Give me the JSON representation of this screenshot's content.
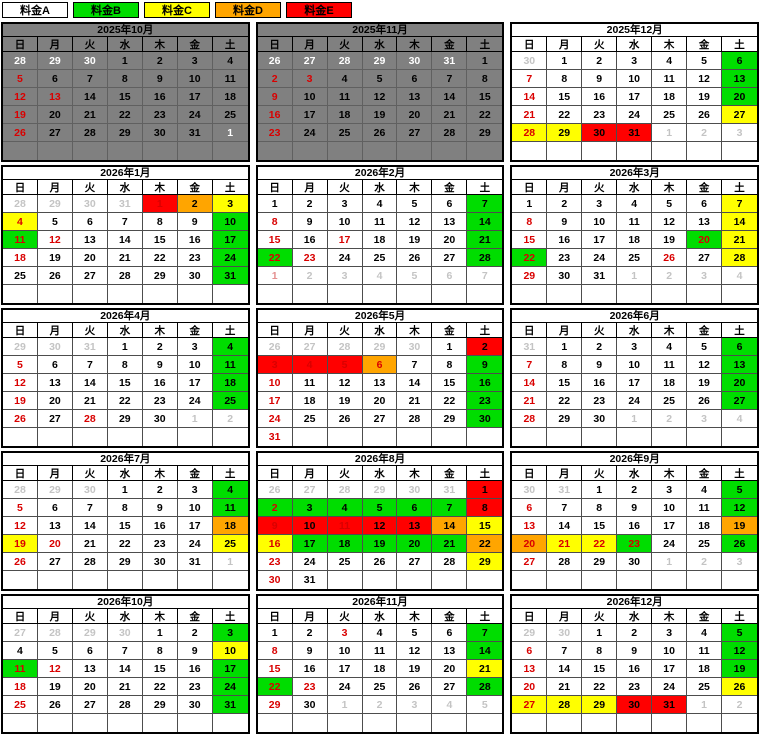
{
  "legend": [
    {
      "label": "料金A",
      "tier": "A"
    },
    {
      "label": "料金B",
      "tier": "B"
    },
    {
      "label": "料金C",
      "tier": "C"
    },
    {
      "label": "料金D",
      "tier": "D"
    },
    {
      "label": "料金E",
      "tier": "E"
    }
  ],
  "colors": {
    "A": "#ffffff",
    "B": "#00dd00",
    "C": "#ffff00",
    "D": "#ffa500",
    "E": "#ff0000",
    "disabled_bg": "#808080",
    "text_black": "#000000",
    "text_red": "#d90000",
    "text_white": "#ffffff",
    "text_dim": "#c4c4c4",
    "text_palered": "#e49090"
  },
  "weekday_headers": [
    "日",
    "月",
    "火",
    "水",
    "木",
    "金",
    "土"
  ],
  "months": [
    {
      "title": "2025年10月",
      "disabled": true,
      "weeks": [
        [
          "28|w",
          "29|w",
          "30|w",
          "1|k",
          "2|k",
          "3|k",
          "4|k"
        ],
        [
          "5|r",
          "6|k",
          "7|k",
          "8|k",
          "9|k",
          "10|k",
          "11|k"
        ],
        [
          "12|r",
          "13|r",
          "14|k",
          "15|k",
          "16|k",
          "17|k",
          "18|k"
        ],
        [
          "19|r",
          "20|k",
          "21|k",
          "22|k",
          "23|k",
          "24|k",
          "25|k"
        ],
        [
          "26|r",
          "27|k",
          "28|k",
          "29|k",
          "30|k",
          "31|k",
          "1|w"
        ],
        [
          "",
          "",
          "",
          "",
          "",
          "",
          ""
        ]
      ]
    },
    {
      "title": "2025年11月",
      "disabled": true,
      "weeks": [
        [
          "26|w",
          "27|w",
          "28|w",
          "29|w",
          "30|w",
          "31|w",
          "1|k"
        ],
        [
          "2|r",
          "3|r",
          "4|k",
          "5|k",
          "6|k",
          "7|k",
          "8|k"
        ],
        [
          "9|r",
          "10|k",
          "11|k",
          "12|k",
          "13|k",
          "14|k",
          "15|k"
        ],
        [
          "16|r",
          "17|k",
          "18|k",
          "19|k",
          "20|k",
          "21|k",
          "22|k"
        ],
        [
          "23|r",
          "24|k",
          "25|k",
          "26|k",
          "27|k",
          "28|k",
          "29|k"
        ],
        [
          "",
          "",
          "",
          "",
          "",
          "",
          ""
        ]
      ]
    },
    {
      "title": "2025年12月",
      "disabled": false,
      "weeks": [
        [
          "30|g",
          "1|k",
          "2|k",
          "3|k",
          "4|k",
          "5|k",
          "6|k|B"
        ],
        [
          "7|r",
          "8|k",
          "9|k",
          "10|k",
          "11|k",
          "12|k",
          "13|k|B"
        ],
        [
          "14|r",
          "15|k",
          "16|k",
          "17|k",
          "18|k",
          "19|k",
          "20|k|B"
        ],
        [
          "21|r",
          "22|k",
          "23|k",
          "24|k",
          "25|k",
          "26|k",
          "27|k|C"
        ],
        [
          "28|r|C",
          "29|k|C",
          "30|k|E",
          "31|k|E",
          "1|g",
          "2|g",
          "3|g"
        ],
        [
          "",
          "",
          "",
          "",
          "",
          "",
          ""
        ]
      ]
    },
    {
      "title": "2026年1月",
      "disabled": false,
      "weeks": [
        [
          "28|g",
          "29|g",
          "30|g",
          "31|g",
          "1|r|E",
          "2|k|D",
          "3|k|C"
        ],
        [
          "4|r|C",
          "5|k",
          "6|k",
          "7|k",
          "8|k",
          "9|k",
          "10|k|B"
        ],
        [
          "11|r|B",
          "12|r",
          "13|k",
          "14|k",
          "15|k",
          "16|k",
          "17|k|B"
        ],
        [
          "18|r",
          "19|k",
          "20|k",
          "21|k",
          "22|k",
          "23|k",
          "24|k|B"
        ],
        [
          "25|k",
          "26|k",
          "27|k",
          "28|k",
          "29|k",
          "30|k",
          "31|k|B"
        ],
        [
          "",
          "",
          "",
          "",
          "",
          "",
          ""
        ]
      ]
    },
    {
      "title": "2026年2月",
      "disabled": false,
      "weeks": [
        [
          "1|k",
          "2|k",
          "3|k",
          "4|k",
          "5|k",
          "6|k",
          "7|k|B"
        ],
        [
          "8|r",
          "9|k",
          "10|k",
          "11|k",
          "12|k",
          "13|k",
          "14|k|B"
        ],
        [
          "15|r",
          "16|k",
          "17|r",
          "18|k",
          "19|k",
          "20|k",
          "21|k|B"
        ],
        [
          "22|r|B",
          "23|r",
          "24|k",
          "25|k",
          "26|k",
          "27|k",
          "28|k|B"
        ],
        [
          "1|p",
          "2|g",
          "3|g",
          "4|g",
          "5|g",
          "6|g",
          "7|g"
        ],
        [
          "",
          "",
          "",
          "",
          "",
          "",
          ""
        ]
      ]
    },
    {
      "title": "2026年3月",
      "disabled": false,
      "weeks": [
        [
          "1|k",
          "2|k",
          "3|k",
          "4|k",
          "5|k",
          "6|k",
          "7|k|C"
        ],
        [
          "8|r",
          "9|k",
          "10|k",
          "11|k",
          "12|k",
          "13|k",
          "14|k|C"
        ],
        [
          "15|r",
          "16|k",
          "17|k",
          "18|k",
          "19|k",
          "20|r|B",
          "21|k|C"
        ],
        [
          "22|r|B",
          "23|k",
          "24|k",
          "25|k",
          "26|r",
          "27|k",
          "28|k|C"
        ],
        [
          "29|r",
          "30|k",
          "31|k",
          "1|g",
          "2|g",
          "3|g",
          "4|g"
        ],
        [
          "",
          "",
          "",
          "",
          "",
          "",
          ""
        ]
      ]
    },
    {
      "title": "2026年4月",
      "disabled": false,
      "weeks": [
        [
          "29|g",
          "30|g",
          "31|g",
          "1|k",
          "2|k",
          "3|k",
          "4|k|B"
        ],
        [
          "5|r",
          "6|k",
          "7|k",
          "8|k",
          "9|k",
          "10|k",
          "11|k|B"
        ],
        [
          "12|r",
          "13|k",
          "14|k",
          "15|k",
          "16|k",
          "17|k",
          "18|k|B"
        ],
        [
          "19|r",
          "20|k",
          "21|k",
          "22|k",
          "23|k",
          "24|k",
          "25|k|B"
        ],
        [
          "26|r",
          "27|k",
          "28|r",
          "29|k",
          "30|k",
          "1|g",
          "2|g"
        ],
        [
          "",
          "",
          "",
          "",
          "",
          "",
          ""
        ]
      ]
    },
    {
      "title": "2026年5月",
      "disabled": false,
      "weeks": [
        [
          "26|g",
          "27|g",
          "28|g",
          "29|g",
          "30|g",
          "1|k",
          "2|k|E"
        ],
        [
          "3|r|E",
          "4|r|E",
          "5|r|E",
          "6|r|D",
          "7|k",
          "8|k",
          "9|k|B"
        ],
        [
          "10|r",
          "11|k",
          "12|k",
          "13|k",
          "14|k",
          "15|k",
          "16|k|B"
        ],
        [
          "17|r",
          "18|k",
          "19|k",
          "20|k",
          "21|k",
          "22|k",
          "23|k|B"
        ],
        [
          "24|r",
          "25|k",
          "26|k",
          "27|k",
          "28|k",
          "29|k",
          "30|k|B"
        ],
        [
          "31|r",
          "",
          "",
          "",
          "",
          "",
          ""
        ]
      ]
    },
    {
      "title": "2026年6月",
      "disabled": false,
      "weeks": [
        [
          "31|g",
          "1|k",
          "2|k",
          "3|k",
          "4|k",
          "5|k",
          "6|k|B"
        ],
        [
          "7|r",
          "8|k",
          "9|k",
          "10|k",
          "11|k",
          "12|k",
          "13|k|B"
        ],
        [
          "14|r",
          "15|k",
          "16|k",
          "17|k",
          "18|k",
          "19|k",
          "20|k|B"
        ],
        [
          "21|r",
          "22|k",
          "23|k",
          "24|k",
          "25|k",
          "26|k",
          "27|k|B"
        ],
        [
          "28|r",
          "29|k",
          "30|k",
          "1|g",
          "2|g",
          "3|g",
          "4|g"
        ],
        [
          "",
          "",
          "",
          "",
          "",
          "",
          ""
        ]
      ]
    },
    {
      "title": "2026年7月",
      "disabled": false,
      "weeks": [
        [
          "28|g",
          "29|g",
          "30|g",
          "1|k",
          "2|k",
          "3|k",
          "4|k|B"
        ],
        [
          "5|r",
          "6|k",
          "7|k",
          "8|k",
          "9|k",
          "10|k",
          "11|k|B"
        ],
        [
          "12|r",
          "13|k",
          "14|k",
          "15|k",
          "16|k",
          "17|k",
          "18|k|D"
        ],
        [
          "19|r|C",
          "20|r",
          "21|k",
          "22|k",
          "23|k",
          "24|k",
          "25|k|C"
        ],
        [
          "26|r",
          "27|k",
          "28|k",
          "29|k",
          "30|k",
          "31|k",
          "1|g"
        ],
        [
          "",
          "",
          "",
          "",
          "",
          "",
          ""
        ]
      ]
    },
    {
      "title": "2026年8月",
      "disabled": false,
      "weeks": [
        [
          "26|g",
          "27|g",
          "28|g",
          "29|g",
          "30|g",
          "31|g",
          "1|k|E"
        ],
        [
          "2|r|B",
          "3|k|B",
          "4|k|B",
          "5|k|B",
          "6|k|B",
          "7|k|B",
          "8|k|E"
        ],
        [
          "9|r|E",
          "10|k|E",
          "11|r|E",
          "12|k|E",
          "13|k|E",
          "14|k|D",
          "15|k|C"
        ],
        [
          "16|r|C",
          "17|k|B",
          "18|k|B",
          "19|k|B",
          "20|k|B",
          "21|k|B",
          "22|k|D"
        ],
        [
          "23|r",
          "24|k",
          "25|k",
          "26|k",
          "27|k",
          "28|k",
          "29|k|C"
        ],
        [
          "30|r",
          "31|k",
          "",
          "",
          "",
          "",
          ""
        ]
      ]
    },
    {
      "title": "2026年9月",
      "disabled": false,
      "weeks": [
        [
          "30|g",
          "31|g",
          "1|k",
          "2|k",
          "3|k",
          "4|k",
          "5|k|B"
        ],
        [
          "6|r",
          "7|k",
          "8|k",
          "9|k",
          "10|k",
          "11|k",
          "12|k|B"
        ],
        [
          "13|r",
          "14|k",
          "15|k",
          "16|k",
          "17|k",
          "18|k",
          "19|k|D"
        ],
        [
          "20|r|D",
          "21|r|C",
          "22|r|C",
          "23|r|B",
          "24|k",
          "25|k",
          "26|k|B"
        ],
        [
          "27|r",
          "28|k",
          "29|k",
          "30|k",
          "1|g",
          "2|g",
          "3|g"
        ],
        [
          "",
          "",
          "",
          "",
          "",
          "",
          ""
        ]
      ]
    },
    {
      "title": "2026年10月",
      "disabled": false,
      "weeks": [
        [
          "27|g",
          "28|g",
          "29|g",
          "30|g",
          "1|k",
          "2|k",
          "3|k|B"
        ],
        [
          "4|k",
          "5|k",
          "6|k",
          "7|k",
          "8|k",
          "9|k",
          "10|k|C"
        ],
        [
          "11|r|B",
          "12|r",
          "13|k",
          "14|k",
          "15|k",
          "16|k",
          "17|k|B"
        ],
        [
          "18|r",
          "19|k",
          "20|k",
          "21|k",
          "22|k",
          "23|k",
          "24|k|B"
        ],
        [
          "25|r",
          "26|k",
          "27|k",
          "28|k",
          "29|k",
          "30|k",
          "31|k|B"
        ],
        [
          "",
          "",
          "",
          "",
          "",
          "",
          ""
        ]
      ]
    },
    {
      "title": "2026年11月",
      "disabled": false,
      "weeks": [
        [
          "1|k",
          "2|k",
          "3|r",
          "4|k",
          "5|k",
          "6|k",
          "7|k|B"
        ],
        [
          "8|r",
          "9|k",
          "10|k",
          "11|k",
          "12|k",
          "13|k",
          "14|k|B"
        ],
        [
          "15|r",
          "16|k",
          "17|k",
          "18|k",
          "19|k",
          "20|k",
          "21|k|C"
        ],
        [
          "22|r|B",
          "23|r",
          "24|k",
          "25|k",
          "26|k",
          "27|k",
          "28|k|B"
        ],
        [
          "29|r",
          "30|k",
          "1|g",
          "2|g",
          "3|g",
          "4|g",
          "5|g"
        ],
        [
          "",
          "",
          "",
          "",
          "",
          "",
          ""
        ]
      ]
    },
    {
      "title": "2026年12月",
      "disabled": false,
      "weeks": [
        [
          "29|g",
          "30|g",
          "1|k",
          "2|k",
          "3|k",
          "4|k",
          "5|k|B"
        ],
        [
          "6|r",
          "7|k",
          "8|k",
          "9|k",
          "10|k",
          "11|k",
          "12|k|B"
        ],
        [
          "13|r",
          "14|k",
          "15|k",
          "16|k",
          "17|k",
          "18|k",
          "19|k|B"
        ],
        [
          "20|r",
          "21|k",
          "22|k",
          "23|k",
          "24|k",
          "25|k",
          "26|k|C"
        ],
        [
          "27|r|C",
          "28|k|C",
          "29|k|C",
          "30|k|E",
          "31|k|E",
          "1|g",
          "2|g"
        ],
        [
          "",
          "",
          "",
          "",
          "",
          "",
          ""
        ]
      ]
    }
  ]
}
